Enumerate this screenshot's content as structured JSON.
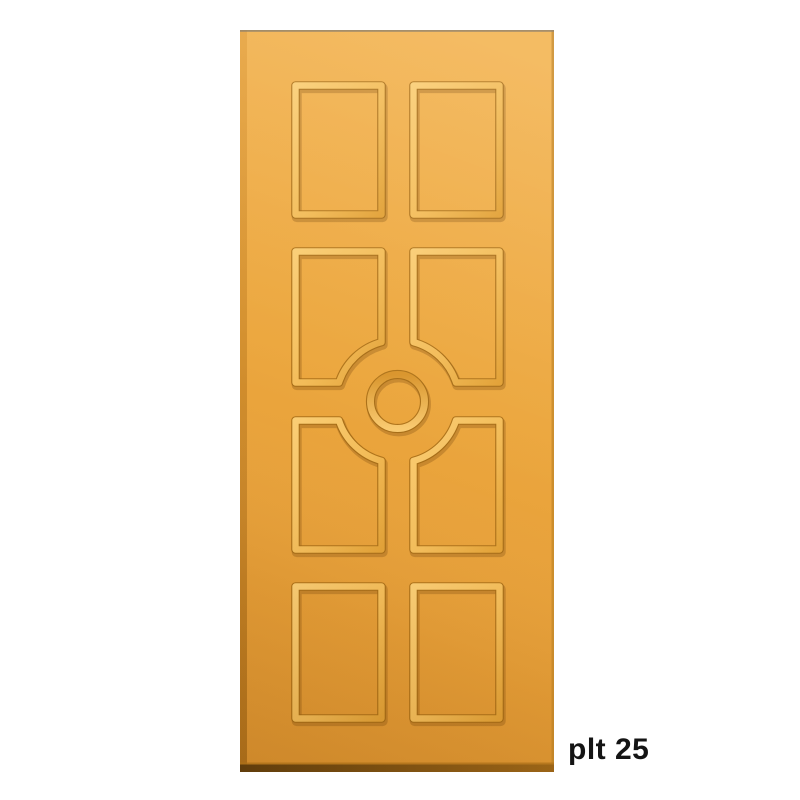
{
  "page": {
    "background": "#FFFFFF"
  },
  "product_render": {
    "subject": "gold eight-panel interior door design",
    "panel_rows": 4,
    "panel_columns": 2,
    "panel_count": 8,
    "center_ornament": "embossed circular ring",
    "middle_panel_detail": "inner corners of the four middle panels are cut with concave quarter-circle arcs around the center ring",
    "colors": {
      "door_face": "#ECA73E",
      "door_face_light": "#F3B452",
      "door_face_dark": "#DE9430",
      "molding_highlight": "#FACD74",
      "molding_shadow": "#9E6511",
      "bottom_edge_dark": "#5E3C0C",
      "bottom_edge_light": "#A06818",
      "top_edge_line": "#8C7A5E",
      "right_edge_line": "#C98B2A"
    }
  },
  "caption": {
    "text": "plt 25",
    "color": "#141414"
  }
}
